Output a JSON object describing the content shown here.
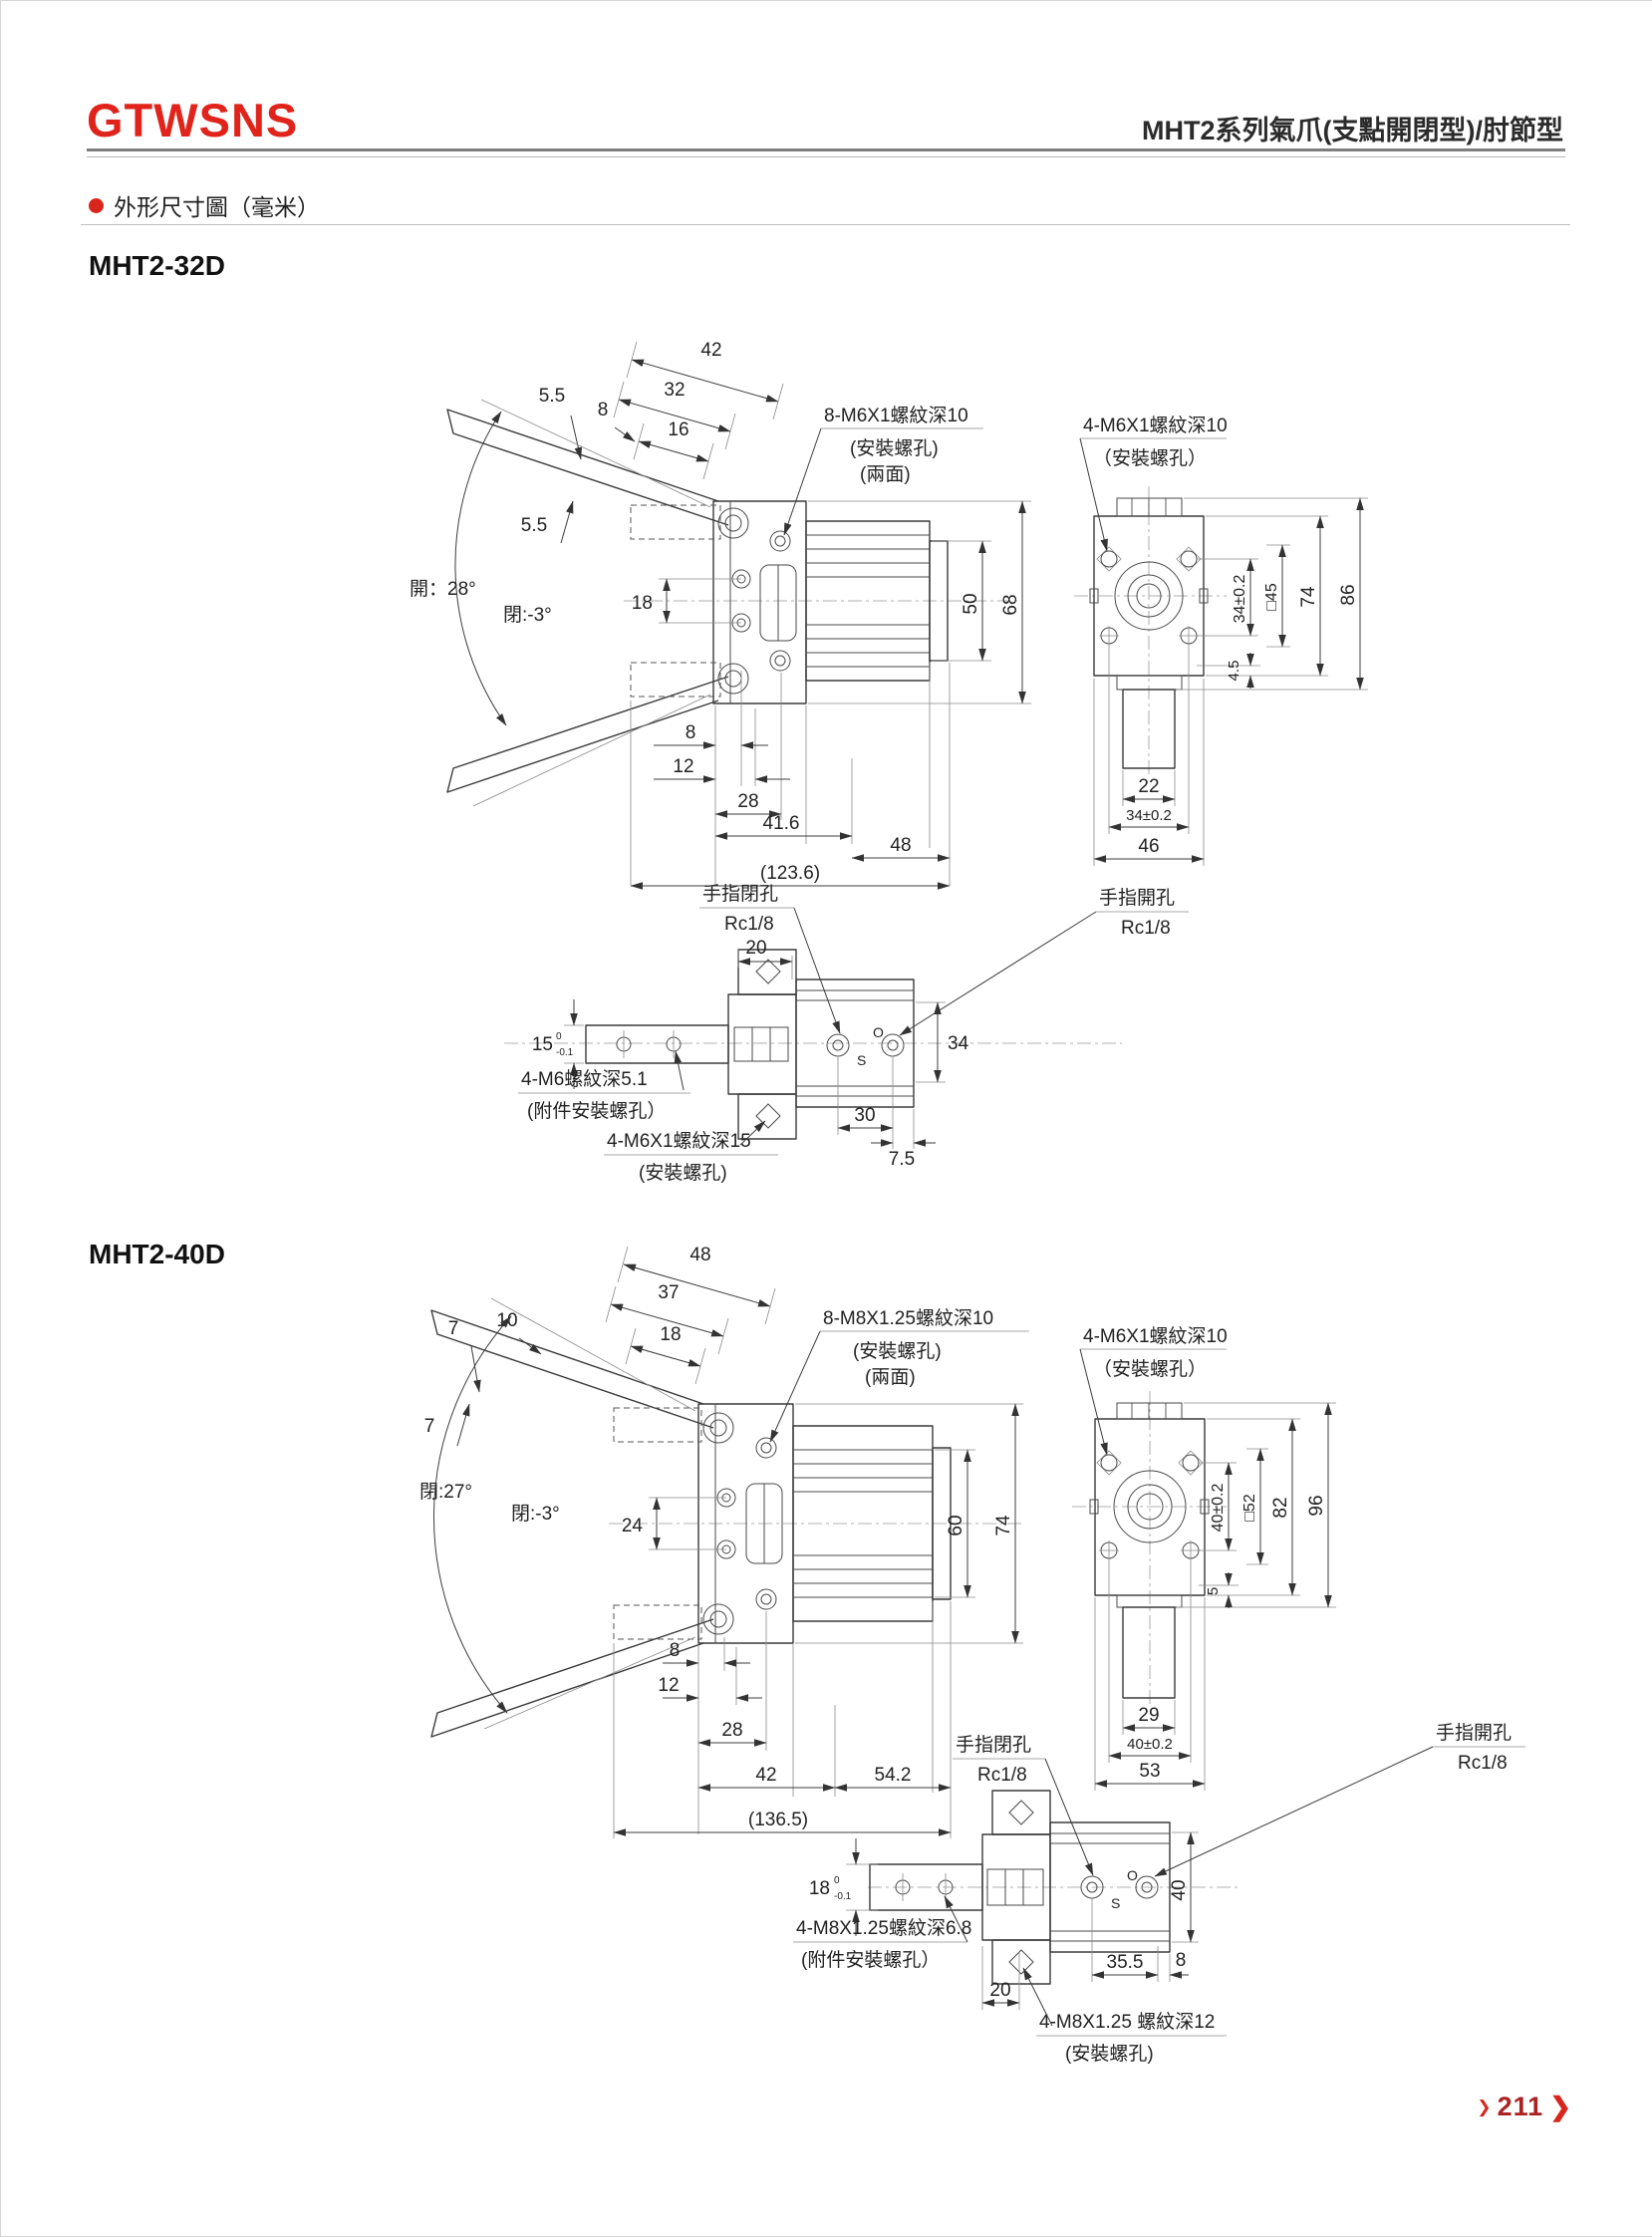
{
  "header": {
    "logo": "GTWSNS",
    "title": "MHT2系列氣爪(支點開閉型)/肘節型"
  },
  "section": {
    "title": "外形尺寸圖（毫米）"
  },
  "m32": {
    "name": "MHT2-32D",
    "front": {
      "d42": "42",
      "d32": "32",
      "d16": "16",
      "d8t": "8",
      "d55a": "5.5",
      "d55b": "5.5",
      "open": "開：28°",
      "close": "閉:-3°",
      "d18": "18",
      "d50": "50",
      "d68": "68",
      "d8": "8",
      "d12": "12",
      "d28": "28",
      "d416": "41.6",
      "d48": "48",
      "total": "(123.6)",
      "n1": "8-M6X1螺紋深10",
      "n1b": "(安裝螺孔)",
      "n1c": "(兩面)"
    },
    "side": {
      "n2": "4-M6X1螺紋深10",
      "n2b": "（安裝螺孔）",
      "d34": "34±0.2",
      "dsq": "□45",
      "d74": "74",
      "d86": "86",
      "d45": "4.5",
      "d22": "22",
      "d34b": "34±0.2",
      "d46": "46"
    },
    "bottom": {
      "close": "手指閉孔",
      "closep": "Rc1/8",
      "open": "手指開孔",
      "openp": "Rc1/8",
      "d20": "20",
      "d15": "15",
      "tolTop": "0",
      "tolBot": "-0.1",
      "d34": "34",
      "d30": "30",
      "d75": "7.5",
      "n3": "4-M6螺紋深5.1",
      "n3b": "(附件安裝螺孔）",
      "n4": "4-M6X1螺紋深15",
      "n4b": "(安裝螺孔)",
      "s": "S",
      "o": "O"
    }
  },
  "m40": {
    "name": "MHT2-40D",
    "front": {
      "d48": "48",
      "d37": "37",
      "d10": "10",
      "d18": "18",
      "d7a": "7",
      "d7b": "7",
      "open": "閉:27°",
      "close": "閉:-3°",
      "d24": "24",
      "d60": "60",
      "d74": "74",
      "d8": "8",
      "d12": "12",
      "d28": "28",
      "d42": "42",
      "d542": "54.2",
      "total": "(136.5)",
      "n1": "8-M8X1.25螺紋深10",
      "n1b": "(安裝螺孔)",
      "n1c": "(兩面)"
    },
    "side": {
      "n2": "4-M6X1螺紋深10",
      "n2b": "（安裝螺孔）",
      "d40": "40±0.2",
      "dsq": "□52",
      "d82": "82",
      "d96": "96",
      "d5": "5",
      "d29": "29",
      "d40b": "40±0.2",
      "d53": "53"
    },
    "bottom": {
      "close": "手指閉孔",
      "closep": "Rc1/8",
      "open": "手指開孔",
      "openp": "Rc1/8",
      "d18": "18",
      "tolTop": "0",
      "tolBot": "-0.1",
      "d40": "40",
      "d355": "35.5",
      "d8": "8",
      "d20": "20",
      "n3": "4-M8X1.25螺紋深6.8",
      "n3b": "(附件安裝螺孔）",
      "n4": "4-M8X1.25 螺紋深12",
      "n4b": "(安裝螺孔)",
      "s": "S",
      "o": "O"
    }
  },
  "footer": {
    "page": "211",
    "chev": "❯"
  }
}
